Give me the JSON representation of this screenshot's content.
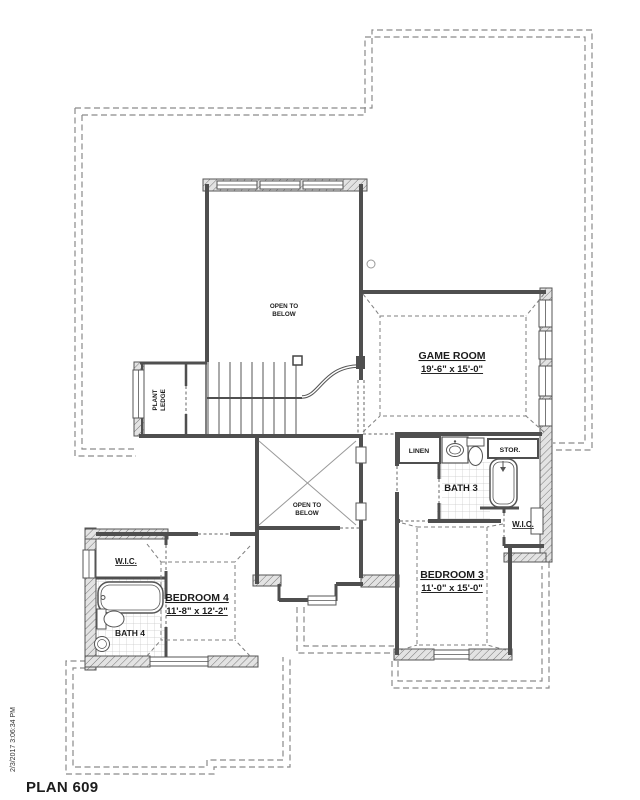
{
  "meta": {
    "plan_title": "PLAN 609",
    "timestamp": "2/3/2017 3:06:34 PM"
  },
  "rooms": {
    "game_room": {
      "name": "GAME ROOM",
      "dims": "19'-6\" x 15'-0\""
    },
    "bedroom_3": {
      "name": "BEDROOM 3",
      "dims": "11'-0\" x 15'-0\""
    },
    "bedroom_4": {
      "name": "BEDROOM 4",
      "dims": "11'-8\" x 12'-2\""
    },
    "bath_3": {
      "name": "BATH 3"
    },
    "bath_4": {
      "name": "BATH 4"
    },
    "wic_left": {
      "name": "W.I.C."
    },
    "wic_right": {
      "name": "W.I.C."
    },
    "linen": {
      "name": "LINEN"
    },
    "storage": {
      "name": "STOR."
    },
    "plant_ledge": {
      "line1": "PLANT",
      "line2": "LEDGE"
    },
    "open_below_upper": {
      "line1": "OPEN TO",
      "line2": "BELOW"
    },
    "open_below_shaft": {
      "line1": "OPEN TO",
      "line2": "BELOW"
    }
  },
  "colors": {
    "ink": "#1c1c1c",
    "wall": "#4f4f4f",
    "roof_dash": "#8a8a8a",
    "tile_line": "#c8c8c8"
  }
}
